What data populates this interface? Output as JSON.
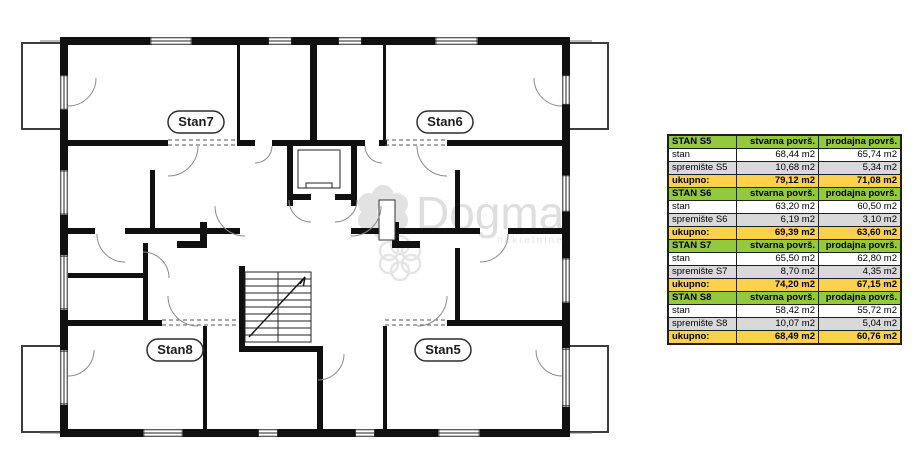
{
  "colors": {
    "table_green": "#94c83d",
    "table_yellow": "#fdd14b",
    "table_gray": "#d9d9d9",
    "plan_wall": "#101010",
    "watermark": "#e2e2e2"
  },
  "plan": {
    "labels": {
      "s7": "Stan7",
      "s6": "Stan6",
      "s8": "Stan8",
      "s5": "Stan5"
    },
    "watermark": {
      "brand": "Dogma",
      "subtext": "nekretnine"
    }
  },
  "table": {
    "groups": [
      {
        "name": "STAN S5",
        "col2": "stvarna površ.",
        "col3": "prodajna površ.",
        "rows": [
          {
            "label": "stan",
            "stvarna": "68,44 m2",
            "prodajna": "65,74 m2"
          },
          {
            "label": "spremište S5",
            "stvarna": "10,68 m2",
            "prodajna": "5,34 m2"
          }
        ],
        "total": {
          "label": "ukupno:",
          "stvarna": "79,12 m2",
          "prodajna": "71,08 m2"
        }
      },
      {
        "name": "STAN S6",
        "col2": "stvarna površ.",
        "col3": "prodajna površ.",
        "rows": [
          {
            "label": "stan",
            "stvarna": "63,20 m2",
            "prodajna": "60,50 m2"
          },
          {
            "label": "spremište S6",
            "stvarna": "6,19 m2",
            "prodajna": "3,10 m2"
          }
        ],
        "total": {
          "label": "ukupno:",
          "stvarna": "69,39 m2",
          "prodajna": "63,60 m2"
        }
      },
      {
        "name": "STAN S7",
        "col2": "stvarna površ.",
        "col3": "prodajna površ.",
        "rows": [
          {
            "label": "stan",
            "stvarna": "65,50 m2",
            "prodajna": "62,80 m2"
          },
          {
            "label": "spremište S7",
            "stvarna": "8,70 m2",
            "prodajna": "4,35 m2"
          }
        ],
        "total": {
          "label": "ukupno:",
          "stvarna": "74,20 m2",
          "prodajna": "67,15 m2"
        }
      },
      {
        "name": "STAN S8",
        "col2": "stvarna površ.",
        "col3": "prodajna površ.",
        "rows": [
          {
            "label": "stan",
            "stvarna": "58,42 m2",
            "prodajna": "55,72 m2"
          },
          {
            "label": "spremište S8",
            "stvarna": "10,07 m2",
            "prodajna": "5,04 m2"
          }
        ],
        "total": {
          "label": "ukupno:",
          "stvarna": "68,49 m2",
          "prodajna": "60,76 m2"
        }
      }
    ]
  }
}
